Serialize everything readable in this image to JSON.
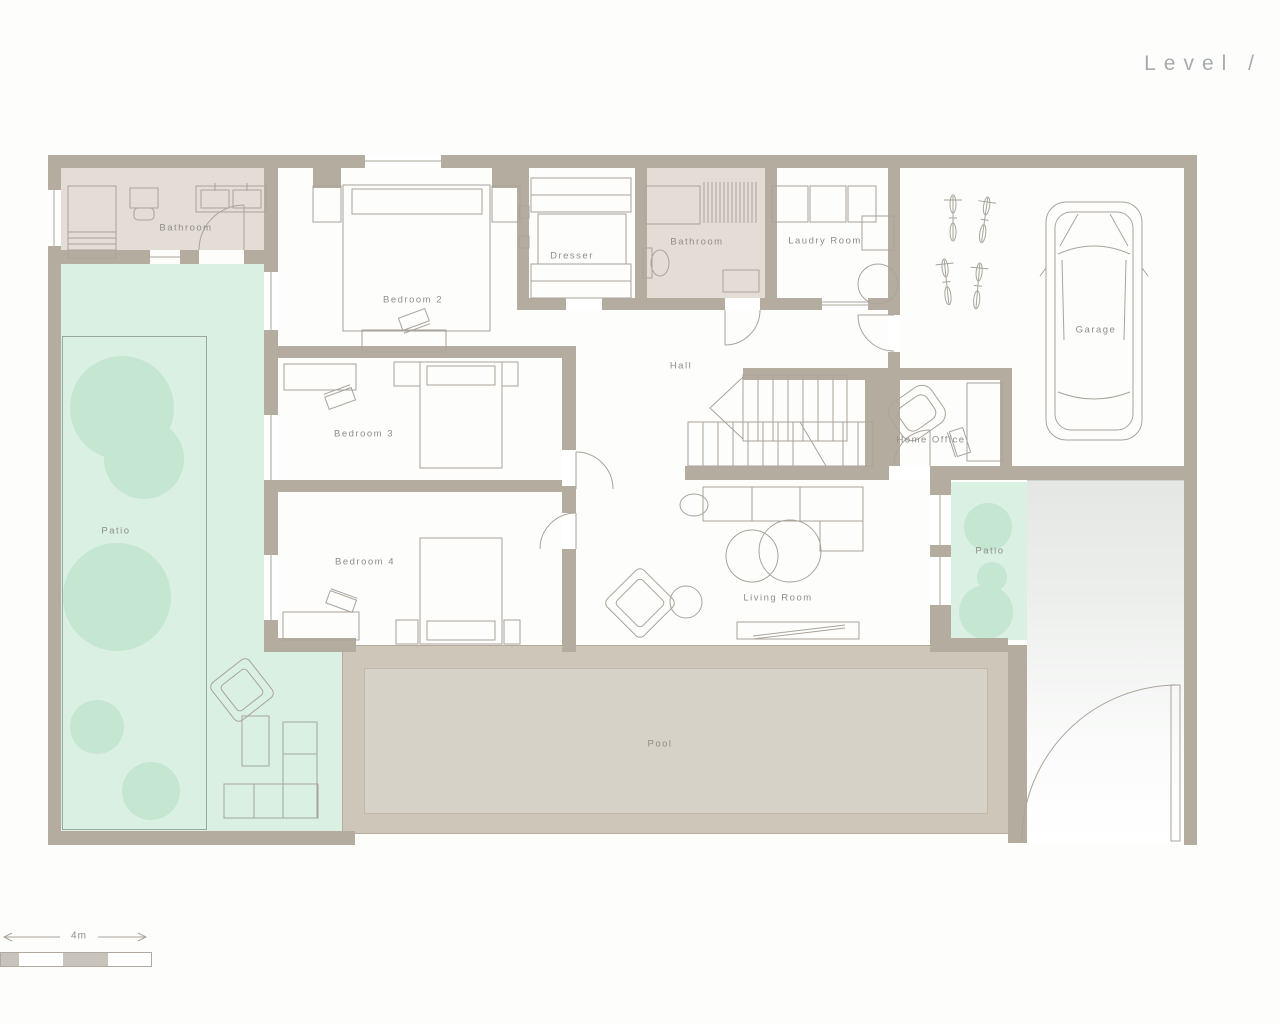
{
  "title": "Level /",
  "scale_bar": {
    "label": "4m"
  },
  "rooms": [
    {
      "id": "bathroom-1",
      "label": "Bathroom"
    },
    {
      "id": "bedroom-2",
      "label": "Bedroom 2"
    },
    {
      "id": "dresser",
      "label": "Dresser"
    },
    {
      "id": "bathroom-2",
      "label": "Bathroom"
    },
    {
      "id": "laundry-room",
      "label": "Laudry Room"
    },
    {
      "id": "garage",
      "label": "Garage"
    },
    {
      "id": "bedroom-3",
      "label": "Bedroom 3"
    },
    {
      "id": "hall",
      "label": "Hall"
    },
    {
      "id": "home-office",
      "label": "Home Office"
    },
    {
      "id": "bedroom-4",
      "label": "Bedroom 4"
    },
    {
      "id": "living-room",
      "label": "Living Room"
    },
    {
      "id": "patio-left",
      "label": "Patio"
    },
    {
      "id": "patio-right",
      "label": "Patio"
    },
    {
      "id": "pool",
      "label": "Pool"
    }
  ],
  "colors": {
    "wall": "#b5aca0",
    "bathroom_floor": "#e4ddd6",
    "patio_green": "#d9f0e3",
    "tree_green": "#c5e6d1",
    "pool_deck": "#cdc6b9",
    "pool_water": "#d7d2c8",
    "driveway_grey": "#e6e9e6",
    "furniture_line": "#a9a49b",
    "label_text": "#8f8d87",
    "title_text": "#a6abab"
  }
}
